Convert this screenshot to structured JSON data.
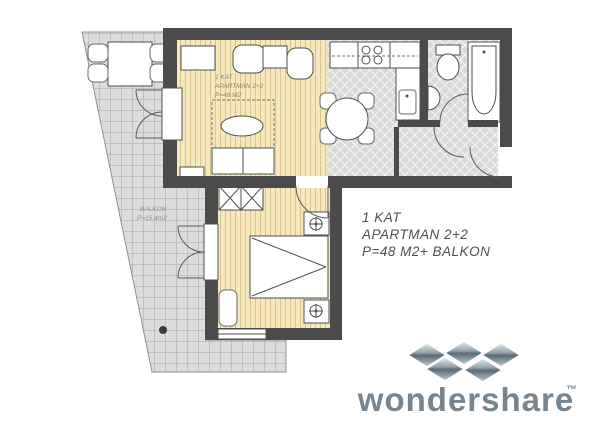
{
  "plan": {
    "room_label": {
      "line1": "1 KAT",
      "line2": "APARTMAN 2+2",
      "line3": "P=48 M2"
    },
    "balcony_label": {
      "line1": "BALKON",
      "line2": "P=15.4m2"
    },
    "caption": {
      "line1": "1 KAT",
      "line2": "APARTMAN 2+2",
      "line3": "P=48 M2+ BALKON"
    }
  },
  "watermark": {
    "brand": "wondershare",
    "tm": "™"
  },
  "colors": {
    "wall": "#4b4b4b",
    "wood_floor": "#f6e8bc",
    "wood_stripe": "#d9c48e",
    "tile_floor": "#d9d9d9",
    "tile_line": "#f2f2f2",
    "balcony_floor": "#dcdcdc",
    "balcony_grid": "#a6a6a6",
    "outline": "#4f4f4f",
    "room_label_text": "#8a7f66",
    "caption_text": "#4f4f4f",
    "logo_text": "#75848f",
    "logo_dark": "#5c6b75",
    "logo_light": "#e9ecee"
  }
}
